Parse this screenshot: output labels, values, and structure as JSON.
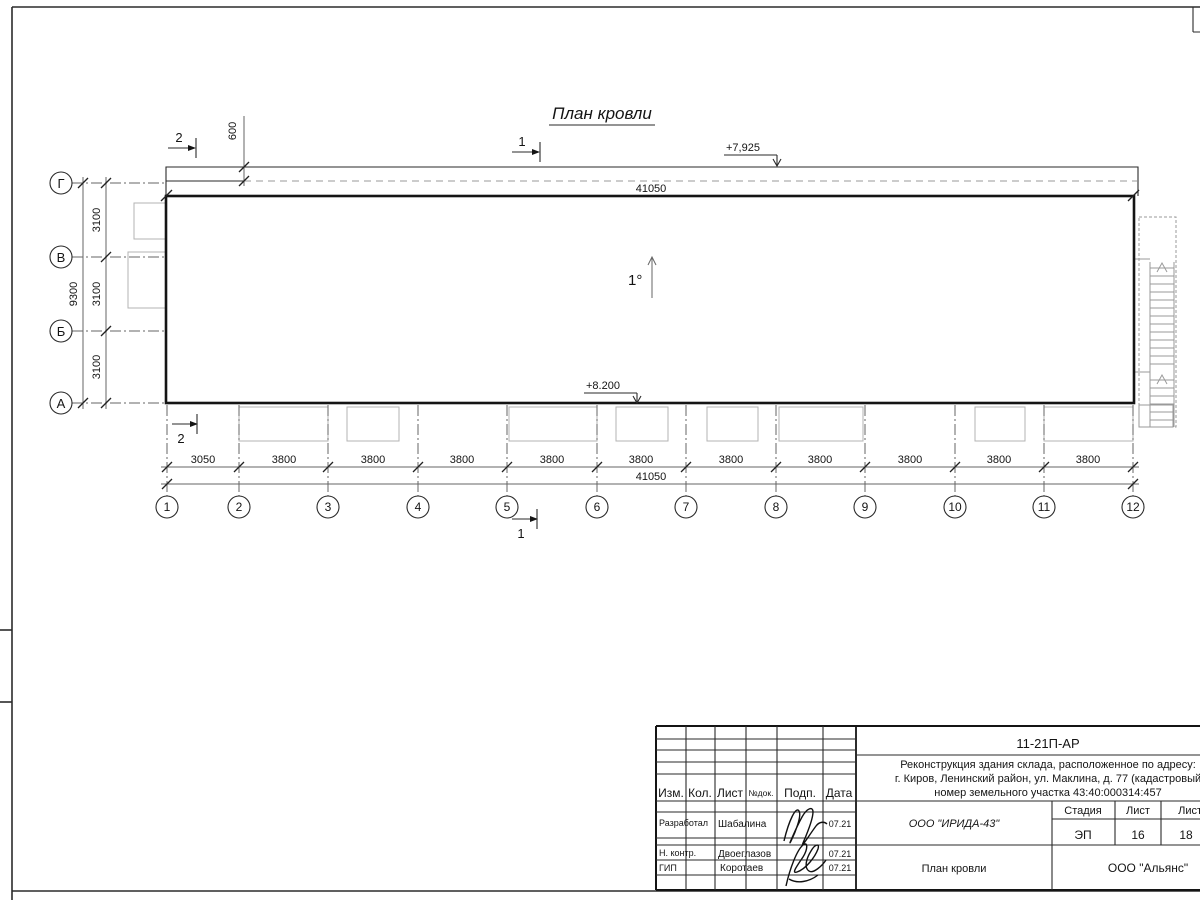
{
  "drawing": {
    "title": "План кровли",
    "slope": "1°",
    "elev_parapet": "+7,925",
    "elev_roof": "+8.200",
    "overhang_dim": "600",
    "top_total": "41050",
    "sections": {
      "s1": "1",
      "s2": "2"
    },
    "grid": {
      "rows": [
        "Г",
        "В",
        "Б",
        "А"
      ],
      "row_dims": [
        "3100",
        "3100",
        "3100"
      ],
      "row_total": "9300",
      "cols": [
        "1",
        "2",
        "3",
        "4",
        "5",
        "6",
        "7",
        "8",
        "9",
        "10",
        "11",
        "12"
      ],
      "col_dims": [
        "3050",
        "3800",
        "3800",
        "3800",
        "3800",
        "3800",
        "3800",
        "3800",
        "3800",
        "3800",
        "3800"
      ],
      "col_total": "41050"
    }
  },
  "title_block": {
    "doc_code": "11-21П-АР",
    "project_line1": "Реконструкция здания склада, расположенное по адресу:",
    "project_line2": "г. Киров, Ленинский район, ул. Маклина, д. 77 (кадастровый",
    "project_line3": "номер земельного участка 43:40:000314:457",
    "org": "ООО \"ИРИДА-43\"",
    "sheet_title": "План кровли",
    "contractor": "ООО \"Альянс\"",
    "stage_label": "Стадия",
    "sheet_label": "Лист",
    "sheets_label": "Листов",
    "stage": "ЭП",
    "sheet_no": "16",
    "sheets_total": "18",
    "columns": {
      "izm": "Изм.",
      "kol": "Кол.",
      "list": "Лист",
      "ndoc": "№док.",
      "podp": "Подп.",
      "data": "Дата"
    },
    "roles": [
      {
        "role": "Разработал",
        "name": "Шабалина",
        "date": "07.21"
      },
      {
        "role": "Н. контр.",
        "name": "Двоеглазов",
        "date": "07.21"
      },
      {
        "role": "ГИП",
        "name": "Коротаев",
        "date": "07.21"
      }
    ]
  }
}
